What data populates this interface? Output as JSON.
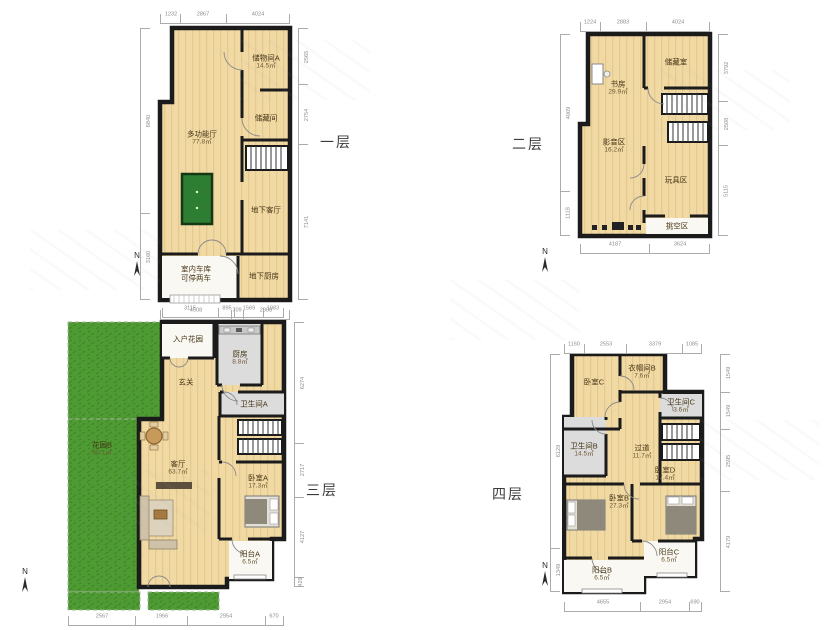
{
  "titles": {
    "f1": "一层",
    "f2": "二层",
    "f3": "三层",
    "f4": "四层"
  },
  "compass_label": "N",
  "colors": {
    "wall": "#1b1b1b",
    "wood": "#f1d9a4",
    "gray_room": "#dcdcdc",
    "white_room": "#faf8f2",
    "grass": "#4e9a33",
    "pool_table": "#2d7d32",
    "dim_text": "#8d8d8d"
  },
  "floors": {
    "f1": {
      "rooms": {
        "storage_a": {
          "name": "储物间A",
          "area": "14.5㎡"
        },
        "storage": {
          "name": "储藏间"
        },
        "multi": {
          "name": "多功能厅",
          "area": "77.8㎡"
        },
        "living": {
          "name": "地下客厅"
        },
        "garage": {
          "name": "室内车库",
          "note": "可停两车"
        },
        "kitchen": {
          "name": "地下厨房"
        }
      },
      "dims": {
        "top": [
          "1232",
          "2867",
          "4024"
        ],
        "bottom": [
          "4508",
          "709",
          "2908"
        ],
        "right": [
          "2565",
          "2754",
          "7141"
        ],
        "left": [
          "6840",
          "3160"
        ]
      }
    },
    "f2": {
      "rooms": {
        "study": {
          "name": "书房",
          "area": "29.9㎡"
        },
        "storeroom": {
          "name": "储藏室"
        },
        "media": {
          "name": "影音区",
          "area": "16.2㎡"
        },
        "toys": {
          "name": "玩具区"
        },
        "void": {
          "name": "挑空区"
        }
      },
      "dims": {
        "top": [
          "1224",
          "2883",
          "4024"
        ],
        "bottom": [
          "4187",
          "3624"
        ],
        "left": [
          "4009",
          "1118"
        ],
        "right": [
          "3792",
          "2508",
          "5115"
        ]
      }
    },
    "f3": {
      "rooms": {
        "garden_b": {
          "name": "花园B",
          "area": "60.1㎡"
        },
        "entry_garden": {
          "name": "入户花园"
        },
        "kitchen": {
          "name": "厨房",
          "area": "8.8㎡"
        },
        "foyer": {
          "name": "玄关"
        },
        "bath_a": {
          "name": "卫生间A"
        },
        "living": {
          "name": "客厅",
          "area": "63.7㎡"
        },
        "bed_a": {
          "name": "卧室A",
          "area": "17.3㎡"
        },
        "balcony_a": {
          "name": "阳台A",
          "area": "6.5㎡"
        }
      },
      "dims": {
        "top": [
          "3115",
          "895",
          "1569",
          "1083"
        ],
        "bottom": [
          "2567",
          "1966",
          "2954",
          "670"
        ],
        "right": [
          "6274",
          "2717",
          "4127",
          "429"
        ]
      }
    },
    "f4": {
      "rooms": {
        "bed_c": {
          "name": "卧室C"
        },
        "closet_b": {
          "name": "衣帽间B",
          "area": "7.6㎡"
        },
        "bath_c": {
          "name": "卫生间C",
          "area": "3.6㎡"
        },
        "hall": {
          "name": "过道",
          "area": "11.7㎡"
        },
        "bath_b": {
          "name": "卫生间B",
          "area": "14.5㎡"
        },
        "bed_b": {
          "name": "卧室B",
          "area": "27.3㎡"
        },
        "bed_d": {
          "name": "卧室D",
          "area": "17.4㎡"
        },
        "balcony_b": {
          "name": "阳台B",
          "area": "6.5㎡"
        },
        "balcony_c": {
          "name": "阳台C",
          "area": "6.5㎡"
        }
      },
      "dims": {
        "top": [
          "1160",
          "2553",
          "3379",
          "1085"
        ],
        "bottom": [
          "4655",
          "2954",
          "690"
        ],
        "left": [
          "6129",
          "1349"
        ],
        "right": [
          "1549",
          "1549",
          "2595",
          "4179"
        ]
      }
    }
  }
}
